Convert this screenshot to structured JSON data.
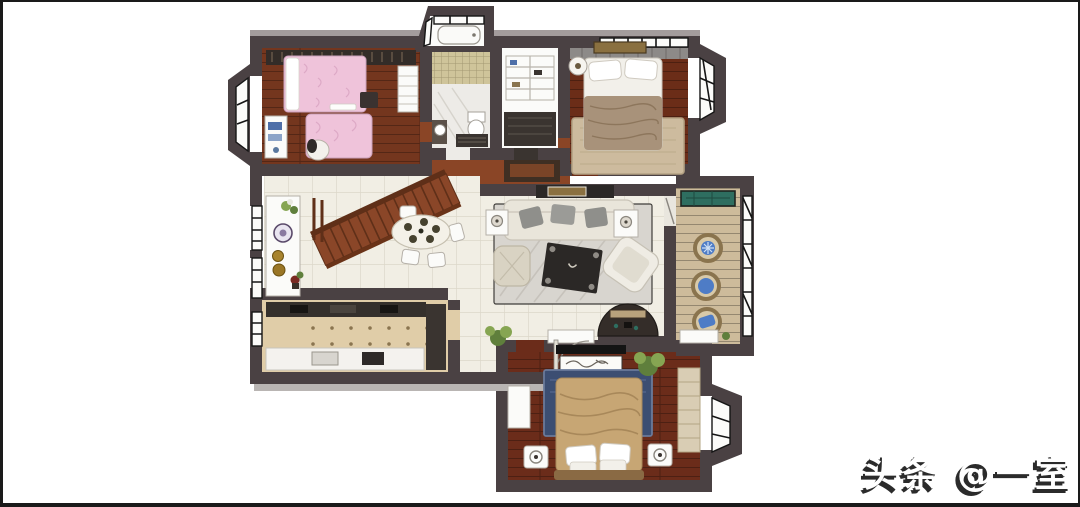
{
  "watermark": {
    "text": "头条 @一室"
  },
  "colors": {
    "bg": "#ffffff",
    "frame": "#1a1a1a",
    "wm-shadow": "#2b2b2b",
    "wall": "#4a4143",
    "wall-light": "#a39c9c",
    "shadow-gray": "#b9b5b3",
    "white": "#fbfbf9",
    "wood-kids": "#74361e",
    "wood-master": "#6b2d18",
    "wood-bedroom": "#6b2c1a",
    "wood-corridor": "#8a4526",
    "tile": "#f1eee4",
    "tile-line": "#dcd7c9",
    "marble": "#edebe7",
    "mosaic": "#cfc49a",
    "mat-dark": "#3a3430",
    "kitchen-floor": "#e0cda8",
    "kitchen-dot": "#8a7550",
    "counter-dark": "#35302c",
    "counter-white": "#f4f2ee",
    "balcony-floor": "#cdbb9b",
    "teal-glass": "#2e6e60",
    "rug-living": "#d8d5cf",
    "rug-tan": "#cdbb9e",
    "rug-blue": "#3c4e72",
    "bed-pink": "#efc3da",
    "bed-tan": "#c7a674",
    "blanket-brown": "#a8927a",
    "sofa-cream": "#e9e5da",
    "pillow-gray": "#8f8f8b",
    "table-dark": "#2b2826",
    "stair-wood": "#8a4628",
    "stair-line": "#5f2f18",
    "blue-cushion": "#4e7cc6",
    "ring-tan": "#8a744e",
    "plant-green": "#5f7f3c",
    "plant-light": "#86a552"
  },
  "scene": {
    "type": "3d-rendered-floor-plan",
    "rooms": [
      {
        "name": "kids-bedroom",
        "position": "top-left",
        "furniture": [
          "wardrobe",
          "pink-bed",
          "pink-rug",
          "desk",
          "chair",
          "bay-window"
        ]
      },
      {
        "name": "bathroom",
        "position": "top-center",
        "furniture": [
          "bathtub-bay-window",
          "mosaic-shower",
          "toilet",
          "vanity"
        ]
      },
      {
        "name": "walk-in-closet",
        "position": "top-center",
        "furniture": [
          "shelf-unit",
          "dark-mat"
        ]
      },
      {
        "name": "master-bedroom",
        "position": "top-right",
        "furniture": [
          "double-bed",
          "brown-blanket",
          "tan-rug",
          "round-side-table",
          "wall-art",
          "bay-window"
        ]
      },
      {
        "name": "hallway",
        "position": "center",
        "furniture": [
          "wood-cabinet"
        ]
      },
      {
        "name": "dining-room",
        "position": "middle-left",
        "furniture": [
          "staircase",
          "dining-table",
          "chairs",
          "sideboard",
          "decorative-plates",
          "windows"
        ]
      },
      {
        "name": "living-room",
        "position": "center",
        "furniture": [
          "sofa",
          "gray-pillows",
          "side-tables-with-lamps",
          "coffee-table",
          "armchair",
          "pouf",
          "console",
          "arc-tv-console",
          "rug"
        ]
      },
      {
        "name": "balcony",
        "position": "right",
        "furniture": [
          "teal-glass-panel",
          "three-round-rattan-seats-blue-cushions",
          "cabinet",
          "lattice-windows"
        ]
      },
      {
        "name": "kitchen",
        "position": "bottom-left",
        "furniture": [
          "dark-counter",
          "white-counter",
          "tall-cabinet",
          "window"
        ]
      },
      {
        "name": "entry",
        "position": "bottom-center",
        "furniture": [
          "plant",
          "shoe-cabinet",
          "entry-door"
        ]
      },
      {
        "name": "second-bedroom",
        "position": "bottom-center",
        "furniture": [
          "tan-bed",
          "white-pillows",
          "blue-rug",
          "nightstands",
          "tv",
          "wall-art",
          "plant",
          "wardrobe",
          "dresser",
          "bay-window"
        ]
      }
    ]
  }
}
